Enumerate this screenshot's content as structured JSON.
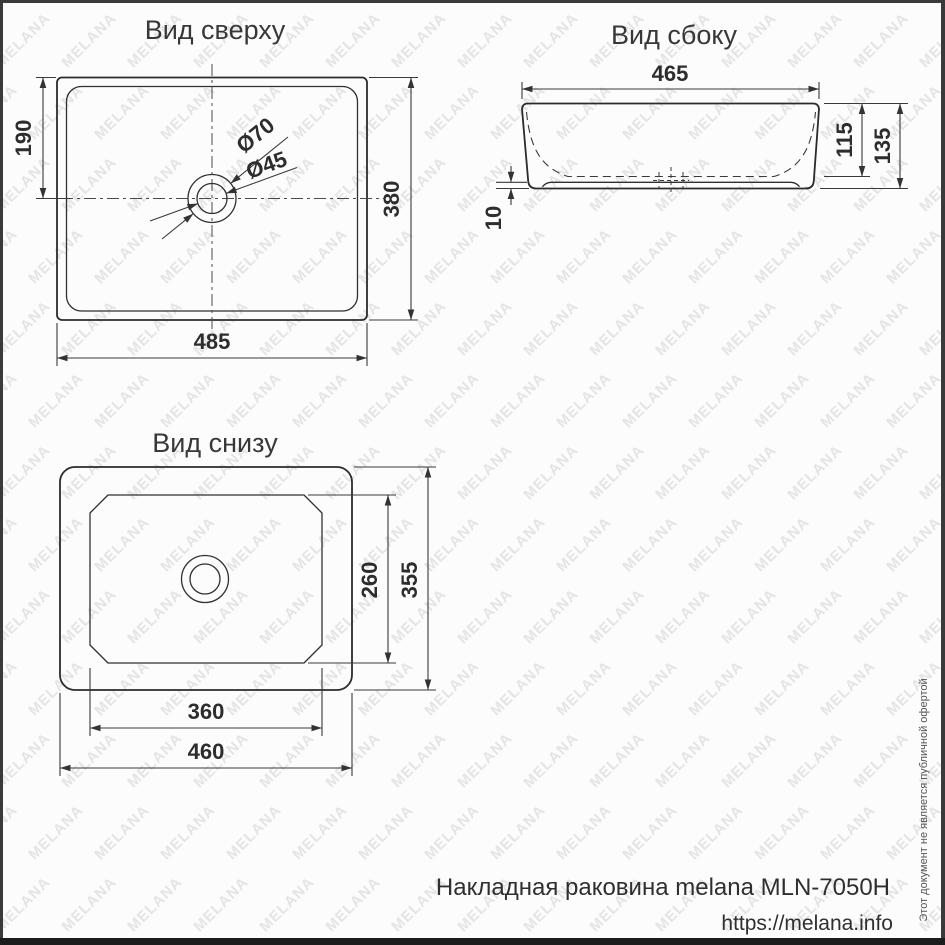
{
  "watermark": {
    "text": "MELANA"
  },
  "views": {
    "top": {
      "title": "Вид сверху",
      "dims": {
        "edge_to_drain": "190",
        "total_depth": "380",
        "total_width": "485",
        "drain_outer": "Ø70",
        "drain_inner": "Ø45"
      }
    },
    "side": {
      "title": "Вид сбоку",
      "dims": {
        "top_width": "465",
        "inner_depth": "115",
        "total_height": "135",
        "base_recess": "10"
      }
    },
    "bottom": {
      "title": "Вид снизу",
      "dims": {
        "inner_depth": "260",
        "total_depth": "355",
        "inner_width": "360",
        "total_width": "460"
      }
    }
  },
  "footer": {
    "product": "Накладная раковина melana MLN-7050H",
    "url": "https://melana.info",
    "disclaimer": "Этот документ не является публичной офертой"
  }
}
